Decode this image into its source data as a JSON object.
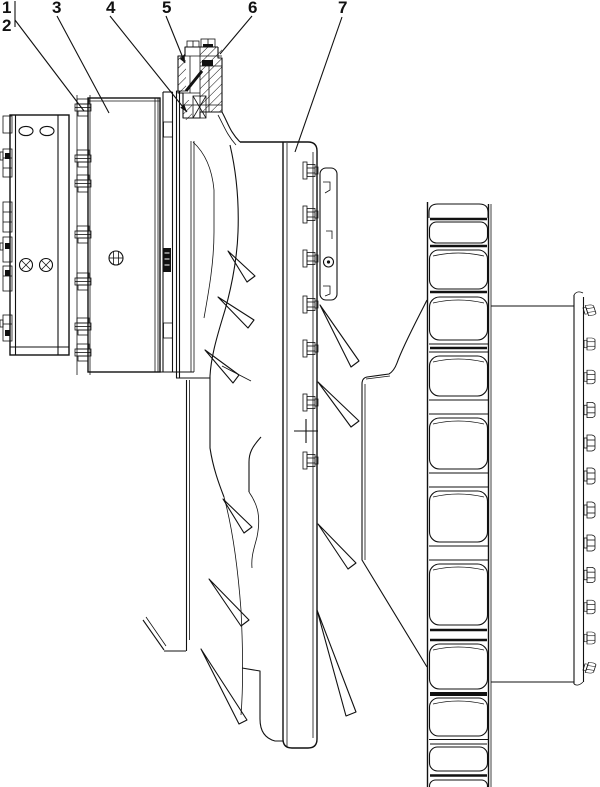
{
  "drawing": {
    "background_color": "#ffffff",
    "line_color": "#111111",
    "callouts": [
      {
        "label": "1"
      },
      {
        "label": "2"
      },
      {
        "label": "3"
      },
      {
        "label": "4"
      },
      {
        "label": "5"
      },
      {
        "label": "6"
      },
      {
        "label": "7"
      }
    ]
  }
}
